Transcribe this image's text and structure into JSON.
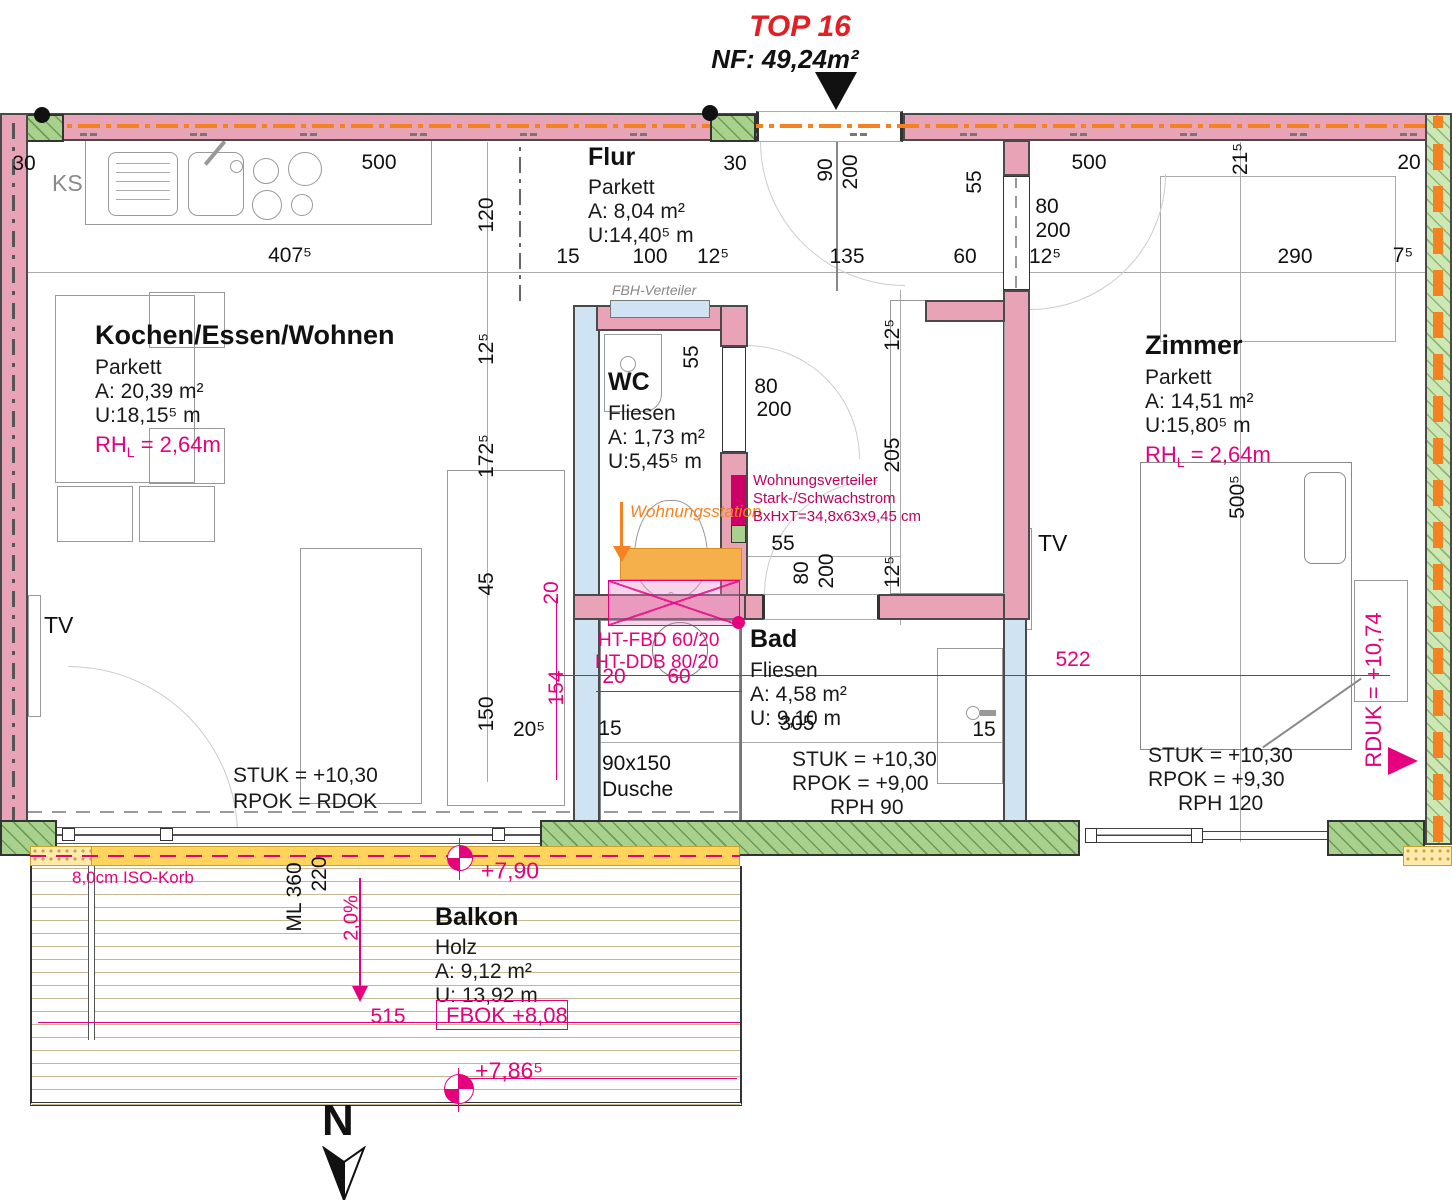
{
  "title": {
    "top": "TOP 16",
    "nf": "NF: 49,24m²"
  },
  "rooms": {
    "wohnen": {
      "name": "Kochen/Essen/Wohnen",
      "l1": "Parkett",
      "l2": "A: 20,39 m²",
      "l3": "U:18,15⁵ m",
      "rh_prefix": "RH",
      "rh_sub": "L",
      "rh_val": " = 2,64m"
    },
    "flur": {
      "name": "Flur",
      "l1": "Parkett",
      "l2": "A:  8,04 m²",
      "l3": "U:14,40⁵ m"
    },
    "wc": {
      "name": "WC",
      "l1": "Fliesen",
      "l2": "A:  1,73 m²",
      "l3": "U:5,45⁵ m"
    },
    "bad": {
      "name": "Bad",
      "l1": "Fliesen",
      "l2": "A:  4,58 m²",
      "l3": "U: 9,10 m"
    },
    "zimmer": {
      "name": "Zimmer",
      "l1": "Parkett",
      "l2": "A: 14,51 m²",
      "l3": "U:15,80⁵ m",
      "rh_prefix": "RH",
      "rh_sub": "L",
      "rh_val": " = 2,64m"
    },
    "balkon": {
      "name": "Balkon",
      "l1": "Holz",
      "l2": "A:  9,12 m²",
      "l3": "U: 13,92 m"
    }
  },
  "levels": {
    "living": {
      "l1": "STUK = +10,30",
      "l2": "RPOK = RDOK"
    },
    "bad": {
      "l1": "STUK = +10,30",
      "l2": "RPOK = +9,00",
      "l3": "RPH  90"
    },
    "zimmer": {
      "l1": "STUK = +10,30",
      "l2": "RPOK = +9,30",
      "l3": "RPH  120"
    }
  },
  "annotations": {
    "ks": "KS",
    "tv_living": "TV",
    "tv_zimmer": "TV",
    "fbh": "FBH-Verteiler",
    "wohnungsstation": "Wohnungsstation",
    "wv1": "Wohnungsverteiler",
    "wv2": "Stark-/Schwachstrom",
    "wv3": "BxHxT=34,8x63x9,45 cm",
    "ht1": "HT-FBD 60/20",
    "ht2": "HT-DDB 80/20",
    "iso": "8,0cm ISO-Korb",
    "fbok": "FBOK +8,08",
    "rduk": "RDUK = +10,74",
    "slope": "2,0%",
    "dusche1": "90x150",
    "dusche2": "Dusche",
    "north": "N"
  },
  "colors": {
    "wall_pink": "#e8a3b6",
    "wall_blue": "#cfe3f2",
    "green": "#a9d18e",
    "orange": "#f58220",
    "magenta": "#e6007e",
    "crimson": "#c00060",
    "title_red": "#e31e24"
  },
  "dims": [
    {
      "t": "30",
      "x": 24,
      "y": 164
    },
    {
      "t": "500",
      "x": 379,
      "y": 163
    },
    {
      "t": "407⁵",
      "x": 290,
      "y": 256
    },
    {
      "t": "120",
      "x": 487,
      "y": 215,
      "rot": true
    },
    {
      "t": "15",
      "x": 568,
      "y": 257
    },
    {
      "t": "100",
      "x": 650,
      "y": 257
    },
    {
      "t": "12⁵",
      "x": 713,
      "y": 257
    },
    {
      "t": "135",
      "x": 847,
      "y": 257
    },
    {
      "t": "60",
      "x": 965,
      "y": 257
    },
    {
      "t": "12⁵",
      "x": 1045,
      "y": 257
    },
    {
      "t": "290",
      "x": 1295,
      "y": 257
    },
    {
      "t": "7⁵",
      "x": 1403,
      "y": 256
    },
    {
      "t": "30",
      "x": 735,
      "y": 164
    },
    {
      "t": "90",
      "x": 826,
      "y": 170,
      "rot": true
    },
    {
      "t": "200",
      "x": 851,
      "y": 172,
      "rot": true
    },
    {
      "t": "55",
      "x": 975,
      "y": 182,
      "rot": true
    },
    {
      "t": "80",
      "x": 1047,
      "y": 207
    },
    {
      "t": "200",
      "x": 1053,
      "y": 231
    },
    {
      "t": "500",
      "x": 1089,
      "y": 163
    },
    {
      "t": "21⁵",
      "x": 1241,
      "y": 159,
      "rot": true
    },
    {
      "t": "20",
      "x": 1409,
      "y": 163
    },
    {
      "t": "12⁵",
      "x": 487,
      "y": 349,
      "rot": true
    },
    {
      "t": "172⁵",
      "x": 487,
      "y": 456,
      "rot": true
    },
    {
      "t": "45",
      "x": 487,
      "y": 584,
      "rot": true
    },
    {
      "t": "150",
      "x": 487,
      "y": 714,
      "rot": true
    },
    {
      "t": "20⁵",
      "x": 529,
      "y": 730
    },
    {
      "t": "20",
      "x": 552,
      "y": 593,
      "rot": true,
      "mag": true
    },
    {
      "t": "154",
      "x": 557,
      "y": 688,
      "rot": true,
      "mag": true
    },
    {
      "t": "55",
      "x": 692,
      "y": 357,
      "rot": true
    },
    {
      "t": "80",
      "x": 766,
      "y": 387
    },
    {
      "t": "200",
      "x": 774,
      "y": 410
    },
    {
      "t": "12⁵",
      "x": 893,
      "y": 335,
      "rot": true
    },
    {
      "t": "205",
      "x": 893,
      "y": 455,
      "rot": true
    },
    {
      "t": "12⁵",
      "x": 893,
      "y": 572,
      "rot": true
    },
    {
      "t": "55",
      "x": 783,
      "y": 544
    },
    {
      "t": "80",
      "x": 802,
      "y": 573,
      "rot": true
    },
    {
      "t": "200",
      "x": 827,
      "y": 571,
      "rot": true
    },
    {
      "t": "20",
      "x": 614,
      "y": 677,
      "mag": true
    },
    {
      "t": "60",
      "x": 679,
      "y": 677,
      "mag": true
    },
    {
      "t": "305",
      "x": 797,
      "y": 724
    },
    {
      "t": "15",
      "x": 610,
      "y": 729
    },
    {
      "t": "15",
      "x": 984,
      "y": 730
    },
    {
      "t": "500⁵",
      "x": 1238,
      "y": 497,
      "rot": true
    },
    {
      "t": "522",
      "x": 1073,
      "y": 660,
      "mag": true
    },
    {
      "t": "515",
      "x": 388,
      "y": 1017,
      "mag": true
    },
    {
      "t": "ML 360",
      "x": 295,
      "y": 897,
      "rot": true
    },
    {
      "t": "220",
      "x": 320,
      "y": 874,
      "rot": true
    },
    {
      "t": "+7,90",
      "x": 510,
      "y": 871,
      "mag": true,
      "big": true
    },
    {
      "t": "+7,86⁵",
      "x": 509,
      "y": 1071,
      "mag": true,
      "big": true
    }
  ]
}
